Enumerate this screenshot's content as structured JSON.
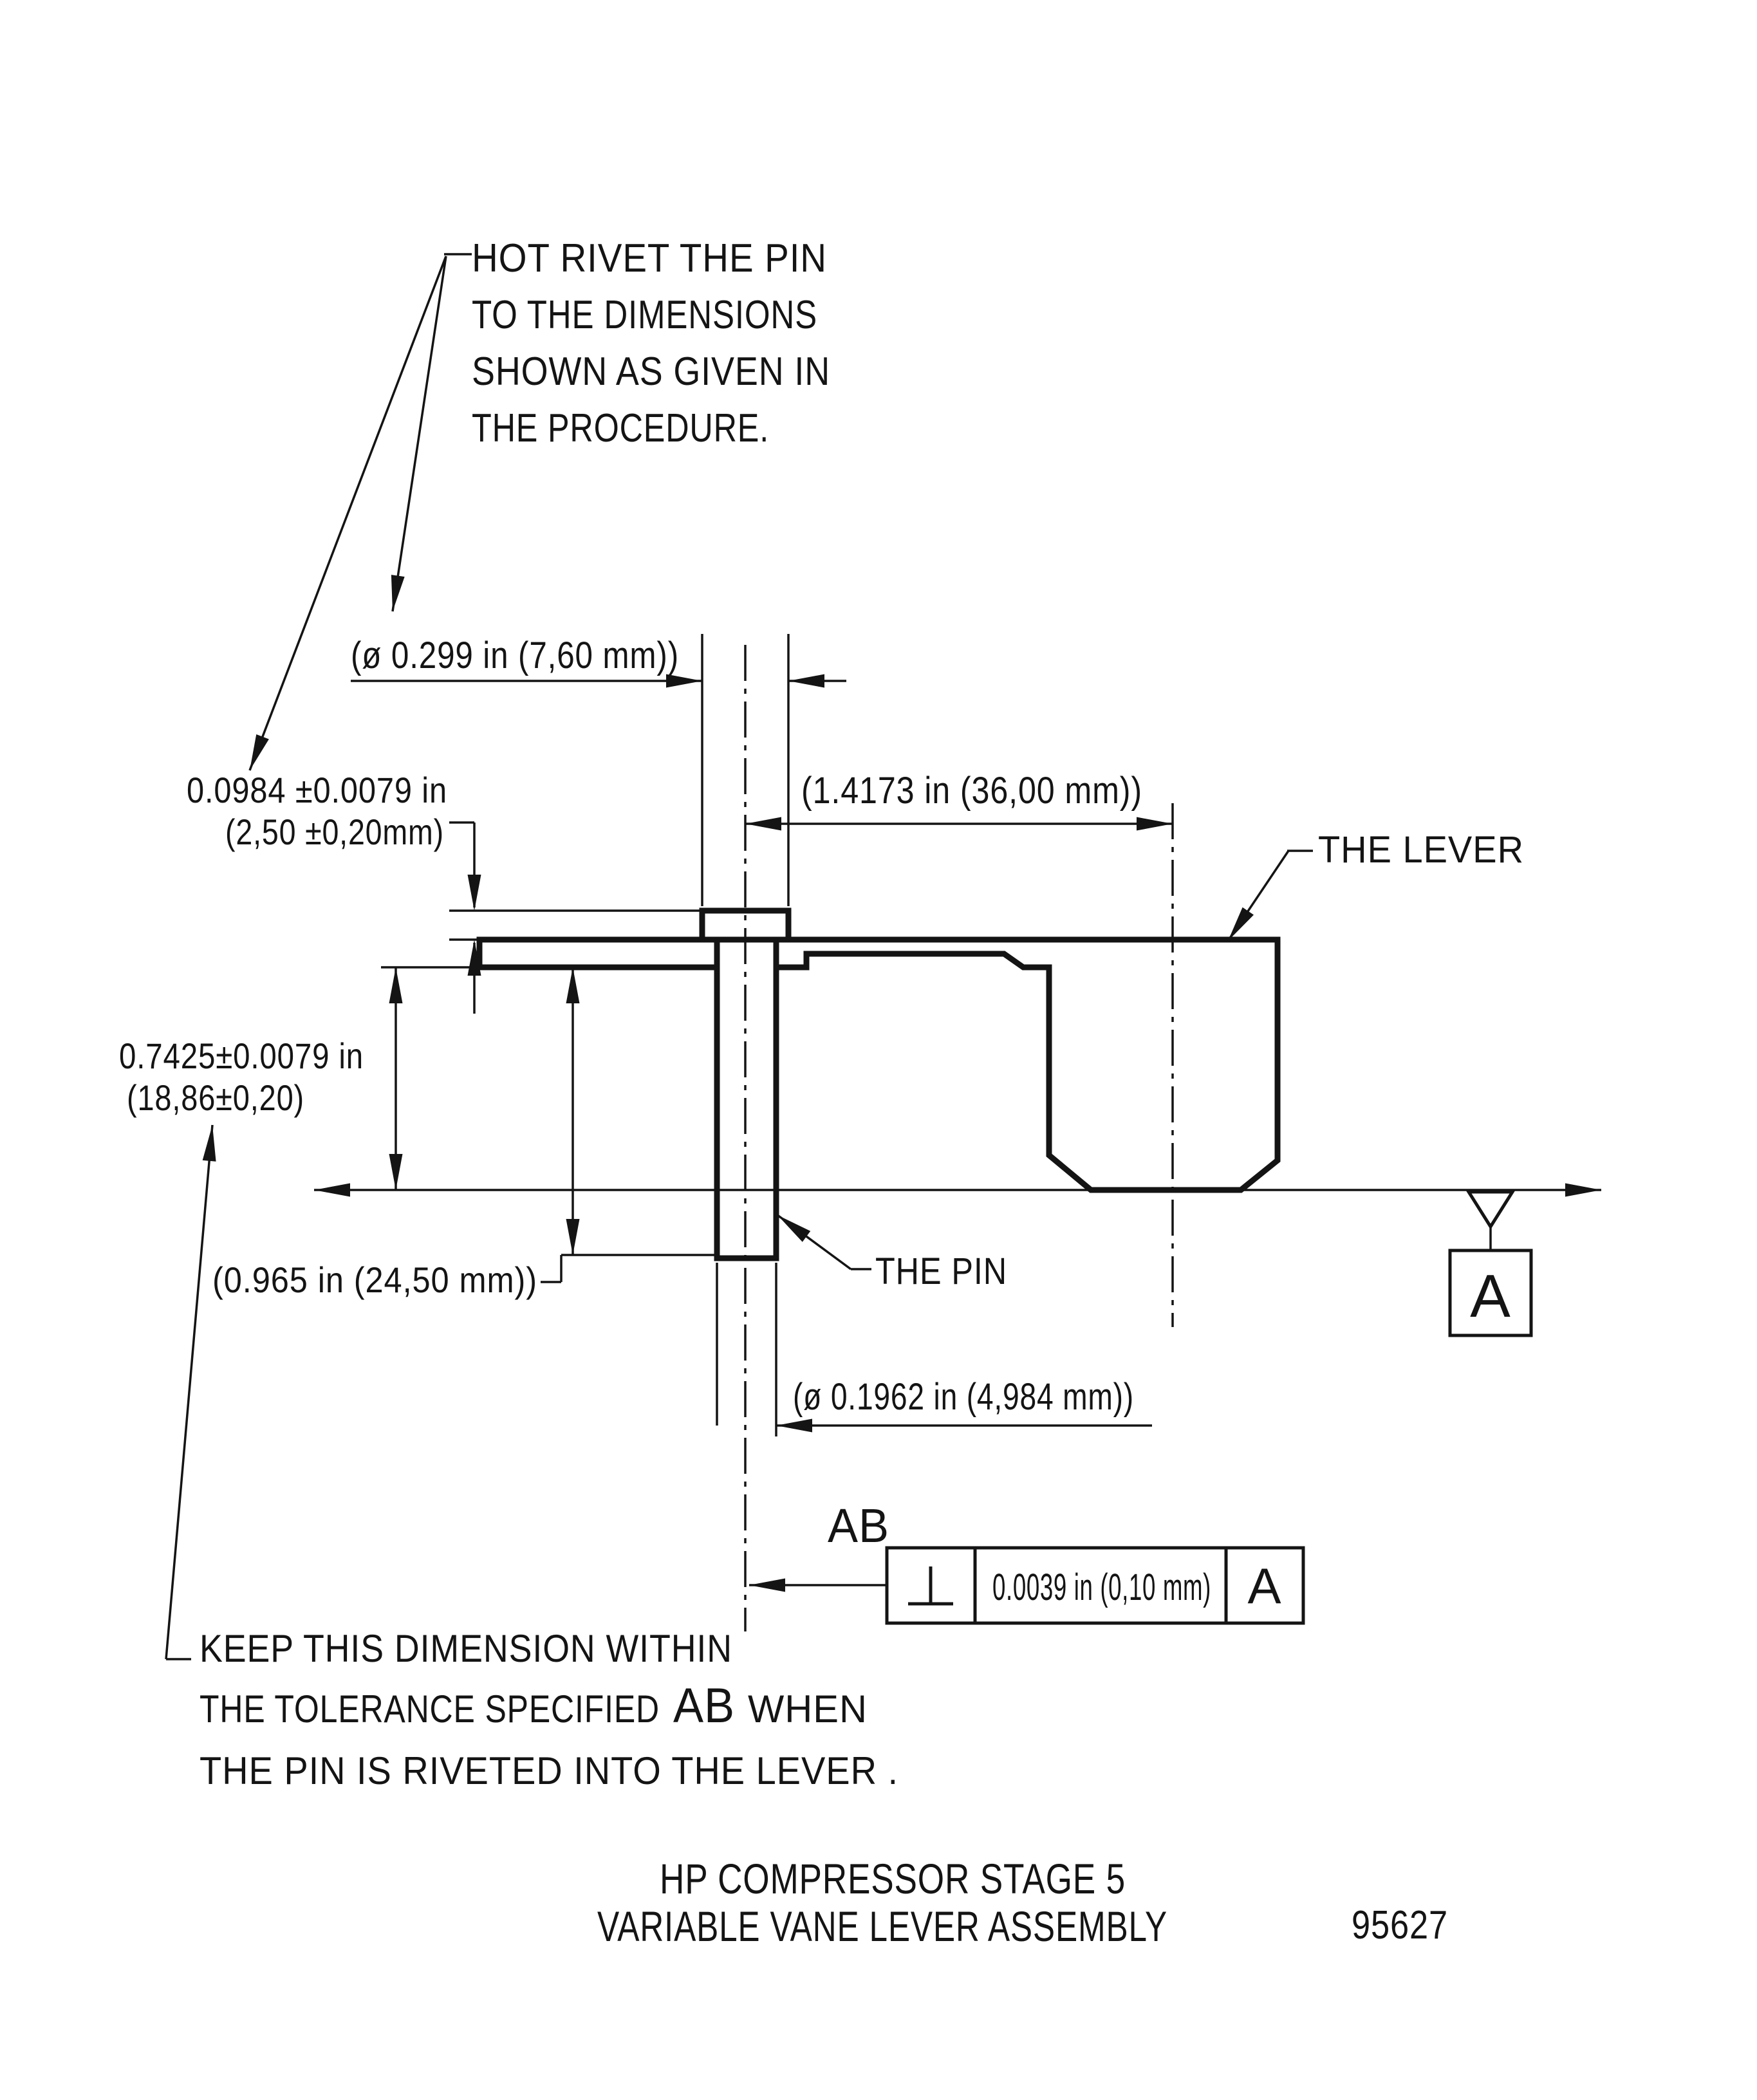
{
  "title": {
    "line1": "HP COMPRESSOR STAGE 5",
    "line2": "VARIABLE VANE LEVER ASSEMBLY",
    "figure_number": "95627"
  },
  "notes": {
    "rivet": {
      "line1": "HOT RIVET THE PIN",
      "line2": "TO THE DIMENSIONS",
      "line3": "SHOWN AS GIVEN IN",
      "line4": "THE PROCEDURE."
    },
    "keep": {
      "line1": "KEEP THIS DIMENSION WITHIN",
      "line2_pre": "THE TOLERANCE SPECIFIED",
      "line2_ref": "AB",
      "line2_post": "WHEN",
      "line3": "THE PIN IS RIVETED INTO THE LEVER ."
    }
  },
  "labels": {
    "lever": "THE LEVER",
    "pin": "THE PIN"
  },
  "dimensions": {
    "rivet_head_diameter": "(ø 0.299 in  (7,60 mm))",
    "lever_span": "(1.4173 in (36,00 mm))",
    "rivet_head_height_in": "0.0984 ±0.0079 in",
    "rivet_head_height_mm": "(2,50 ±0,20mm)",
    "lever_height_in": "0.7425±0.0079 in",
    "lever_height_mm": "(18,86±0,20)",
    "pin_protrusion": "(0.965 in (24,50 mm))",
    "pin_diameter": "(ø 0.1962 in (4,984 mm))"
  },
  "feature_control_frame": {
    "ref_label": "AB",
    "symbol_name": "perpendicularity",
    "tolerance": "0.0039 in  (0,10 mm)",
    "datum_ref": "A"
  },
  "datum": {
    "label": "A"
  }
}
